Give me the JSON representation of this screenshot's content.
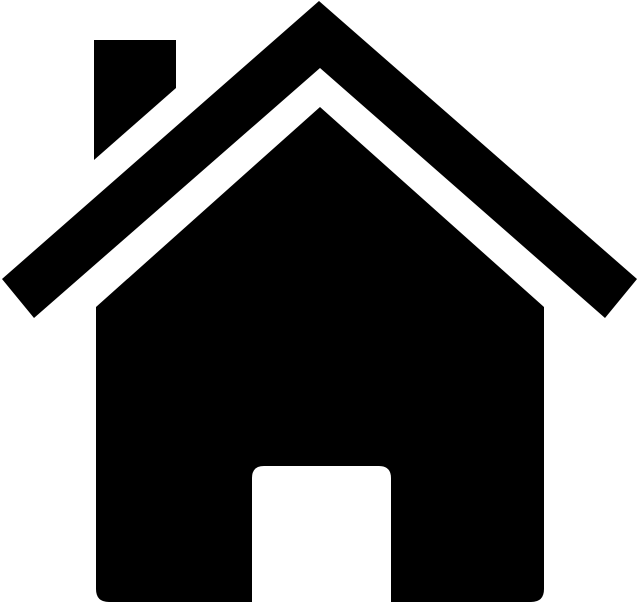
{
  "page": {
    "width": 640,
    "height": 605,
    "background_color": "#ffffff"
  },
  "icon": {
    "name": "house-home-icon",
    "description": "black house silhouette icon with chimney, chevron roof and door cutout",
    "fill_color": "#000000",
    "background_color": "#ffffff",
    "parts": [
      {
        "name": "chimney",
        "d": "M 94 40 L 176 40 L 176 88 L 94 160 Z",
        "fill_rule": "nonzero"
      },
      {
        "name": "roof-chevron",
        "d": "M 319 1 L 2 279 L 34 318 L 320 68 L 605 318 L 637 279 Z",
        "fill_rule": "nonzero"
      },
      {
        "name": "house-body-with-door-cutout",
        "d": "M 320 107 L 544 307 L 544 589 Q 544 602 531 602 L 109 602 Q 96 602 96 589 L 96 307 Z M 252 602 L 252 478 Q 252 466 264 466 L 379 466 Q 391 466 391 478 L 391 602 Z",
        "fill_rule": "evenodd"
      }
    ]
  }
}
